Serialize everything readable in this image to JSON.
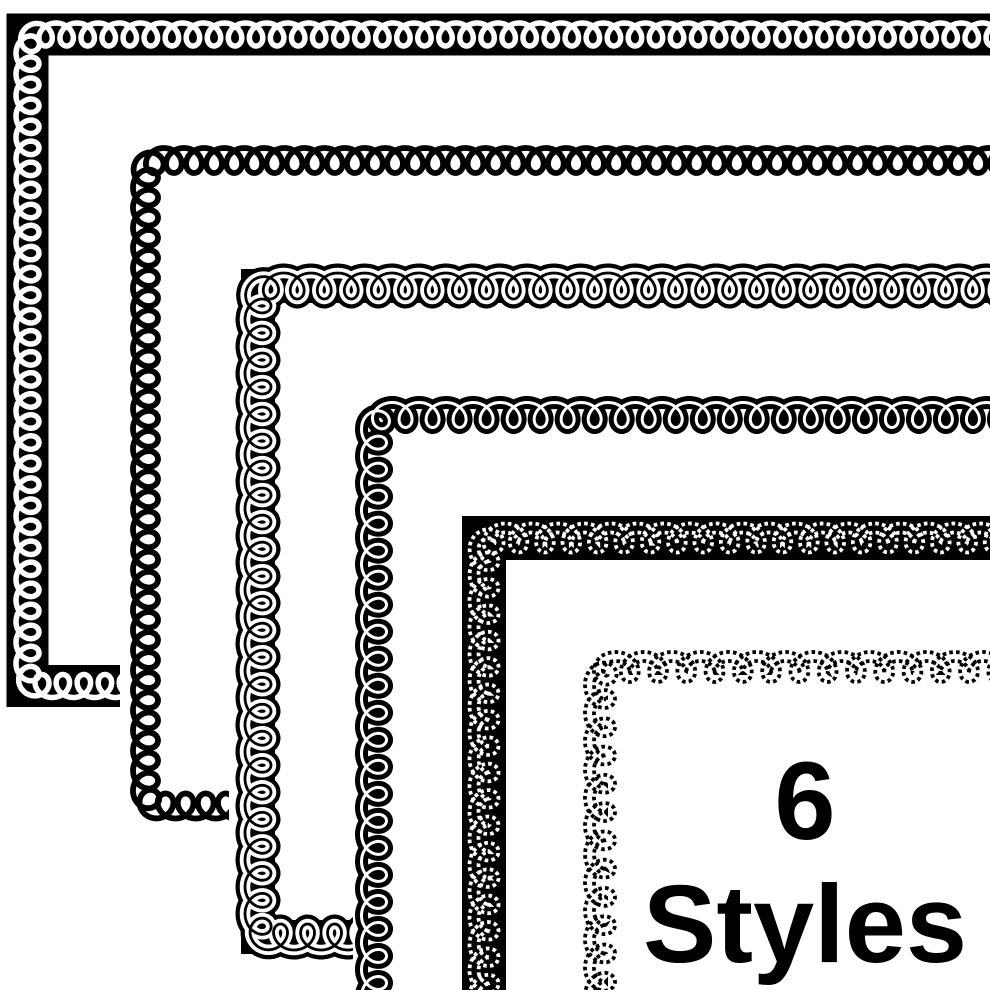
{
  "badge": {
    "count": "6",
    "label": "Styles"
  },
  "colors": {
    "ink": "#000000",
    "paper": "#ffffff"
  },
  "canvas": {
    "width": 990,
    "height": 990,
    "bleed": 1010
  },
  "borders": [
    {
      "name": "white-loops-on-solid-black-band",
      "left": 27.5,
      "top": 34.5,
      "bottom": 686,
      "corner": true,
      "backing": null,
      "a": 3.35,
      "b": 11.5,
      "strokes": [
        {
          "kind": "band",
          "color": "#000000",
          "width": 42
        },
        {
          "kind": "coil",
          "color": "#ffffff",
          "width": 5.5
        }
      ]
    },
    {
      "name": "plain-black-loop-line",
      "left": 145.5,
      "top": 160.5,
      "bottom": 806,
      "corner": true,
      "backing": [
        120,
        134
      ],
      "a": 3.2,
      "b": 12.5,
      "strokes": [
        {
          "kind": "coil",
          "color": "#000000",
          "width": 5.8
        }
      ]
    },
    {
      "name": "outlined-white-loops-on-black-band",
      "left": 258,
      "top": 286,
      "bottom": 937,
      "corner": true,
      "backing": [
        229,
        259
      ],
      "a": 4.3,
      "b": 13,
      "strokes": [
        {
          "kind": "band",
          "color": "#000000",
          "width": 34
        },
        {
          "kind": "coil",
          "color": "#000000",
          "width": 19
        },
        {
          "kind": "coil",
          "color": "#ffffff",
          "width": 10.5
        },
        {
          "kind": "coil",
          "color": "#000000",
          "width": 2.8
        }
      ]
    },
    {
      "name": "black-loops-with-white-centerline",
      "left": 374,
      "top": 415,
      "bottom": 1060,
      "corner": false,
      "backing": [
        353,
        390
      ],
      "a": 4.3,
      "b": 12.5,
      "strokes": [
        {
          "kind": "coil",
          "color": "#000000",
          "width": 13
        },
        {
          "kind": "coil",
          "color": "#ffffff",
          "width": 3
        }
      ]
    },
    {
      "name": "dotted-white-loops-on-black-band",
      "left": 484,
      "top": 538,
      "bottom": 1060,
      "corner": false,
      "backing": [
        457,
        512
      ],
      "a": 4.2,
      "b": 10,
      "strokes": [
        {
          "kind": "band",
          "color": "#000000",
          "width": 44
        },
        {
          "kind": "coil-outline-dotted",
          "color": "#ffffff",
          "width": 3.8,
          "offset": 4.5,
          "dash": [
            3.6,
            3.2
          ]
        }
      ]
    },
    {
      "name": "dotted-black-loops",
      "left": 600,
      "top": 667,
      "bottom": 1060,
      "corner": false,
      "backing": [
        581,
        640
      ],
      "a": 4.5,
      "b": 10.5,
      "strokes": [
        {
          "kind": "coil-outline-dotted",
          "color": "#000000",
          "width": 3.8,
          "offset": 4.5,
          "dash": [
            3.6,
            3.2
          ]
        }
      ]
    }
  ]
}
